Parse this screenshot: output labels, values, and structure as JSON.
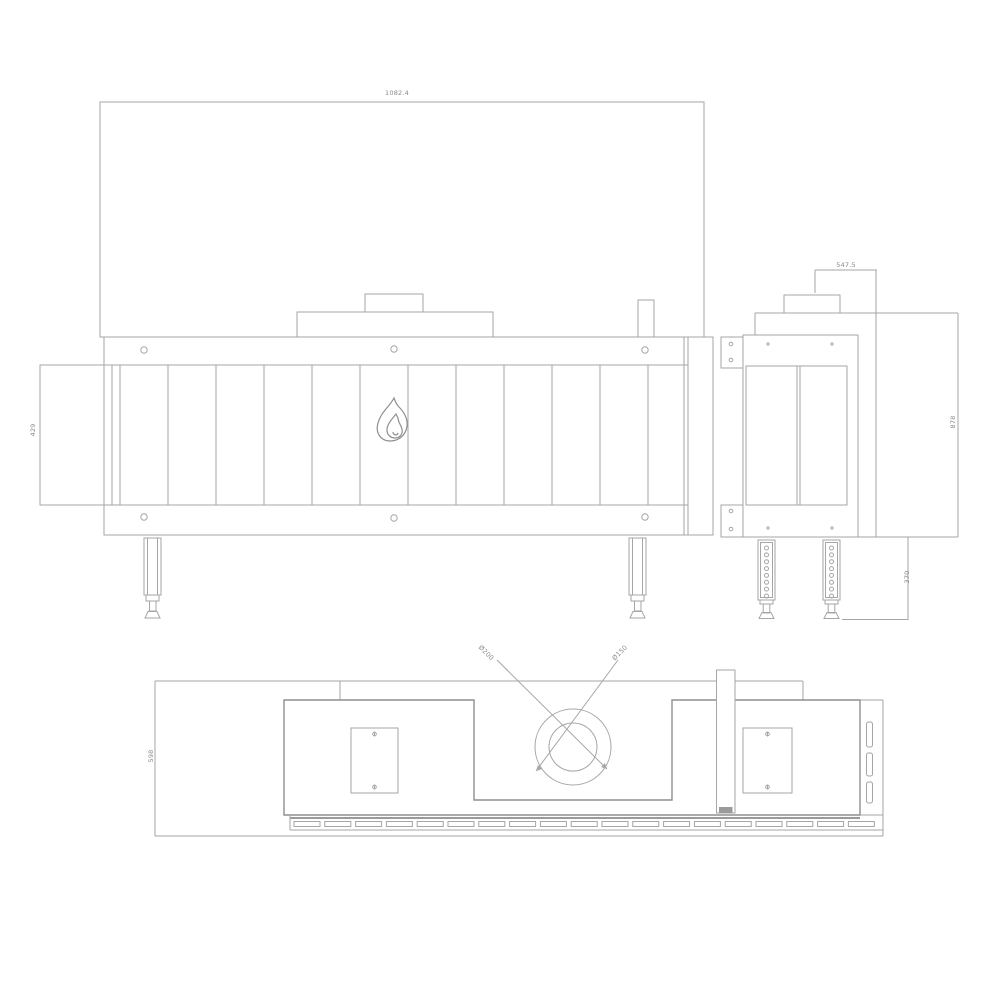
{
  "page": {
    "background_color": "#ffffff"
  },
  "drawing": {
    "line_color": "#a6a6a6",
    "dark_line_color": "#8f8f8f",
    "label_color": "#8a8a8a",
    "icons": {
      "flame_logo": "flame-icon"
    },
    "dimensions": {
      "front_width": "1082.4",
      "front_opening_height": "429",
      "flue_offset": "547.5",
      "overall_height": "878",
      "leg_height": "370",
      "plan_depth": "598",
      "flue_outer_dia": "Ø200",
      "flue_inner_dia": "Ø150"
    }
  }
}
